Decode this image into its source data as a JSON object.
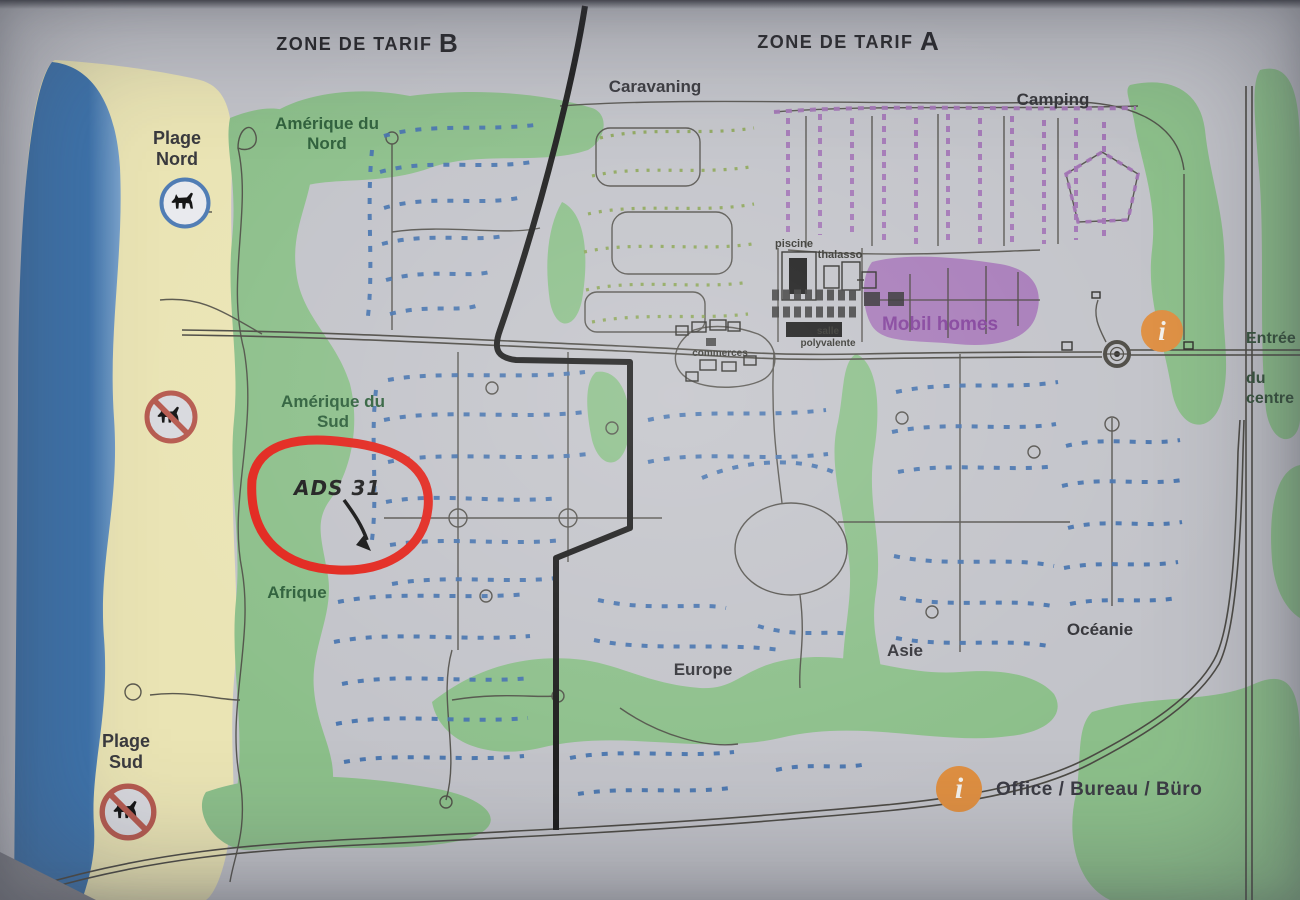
{
  "zones": {
    "zone_b_prefix": "ZONE DE TARIF ",
    "zone_b_letter": "B",
    "zone_a_prefix": "ZONE DE TARIF ",
    "zone_a_letter": "A"
  },
  "area_labels": {
    "caravaning": "Caravaning",
    "camping": "Camping",
    "plage_nord": "Plage Nord",
    "plage_sud": "Plage Sud",
    "amerique_du_nord": "Amérique du Nord",
    "amerique_du_sud": "Amérique du Sud",
    "afrique": "Afrique",
    "europe": "Europe",
    "asie": "Asie",
    "oceanie": "Océanie",
    "mobil_homes": "Mobil homes"
  },
  "facility_labels": {
    "piscine": "piscine",
    "thalasso": "thalasso",
    "commerces": "commerces",
    "salle_polyvalente": "salle polyvalente",
    "entree_line1": "Entrée",
    "entree_line2": "du centre"
  },
  "legend": {
    "info_letter": "i",
    "office_label": "Office / Bureau / Büro"
  },
  "annotation": {
    "handwritten_text": "ADS 31"
  },
  "map_info_icon_letter": "i",
  "colors": {
    "paper": "#c2c3c9",
    "sea": "#3d73ac",
    "sea_light": "#7aa2cb",
    "sand": "#eae4b4",
    "green_area": "#8cbf8a",
    "green_dots": "#8ba556",
    "blue_dots": "#4673ae",
    "purple_area": "#a77bb9",
    "purple_dashes": "#a273b5",
    "purple_label": "#82409b",
    "road": "#4c4a44",
    "boundary": "#1c1c1c",
    "red_annotation": "#e2251c",
    "orange_info": "#df8f41",
    "nodog_red": "#b65a4f",
    "dog_blue": "#4f7cb4",
    "label_dark": "#35353a",
    "label_green": "#2d5f3a",
    "entree_green": "#35523b",
    "photo_edge": "#84858c"
  }
}
